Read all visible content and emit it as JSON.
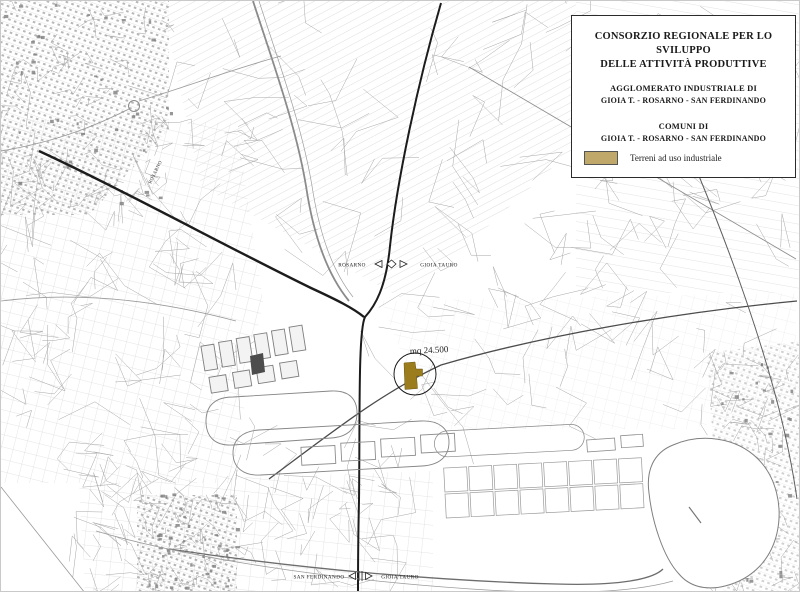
{
  "legend": {
    "title_line1": "CONSORZIO REGIONALE PER LO SVILUPPO",
    "title_line2": "DELLE ATTIVITÀ PRODUTTIVE",
    "section1_heading": "AGGLOMERATO INDUSTRIALE DI",
    "section1_value": "GIOIA T. - ROSARNO - SAN FERDINANDO",
    "section2_heading": "COMUNI DI",
    "section2_value": "GIOIA T. - ROSARNO - SAN FERDINANDO",
    "swatch_label": "Terreni ad uso industriale",
    "swatch_color": "#bfa869"
  },
  "map": {
    "annotation_area": "mq 24.500",
    "annotation_color": "#c03424",
    "parcel_color": "#9c7d1d",
    "mid_marker": {
      "left": "ROSARNO",
      "right": "GIOIA TAURO"
    },
    "bottom_marker": {
      "left": "SAN FERDINANDO",
      "right": "GIOIA TAURO"
    },
    "diagonal_label": "ROSARNO"
  }
}
